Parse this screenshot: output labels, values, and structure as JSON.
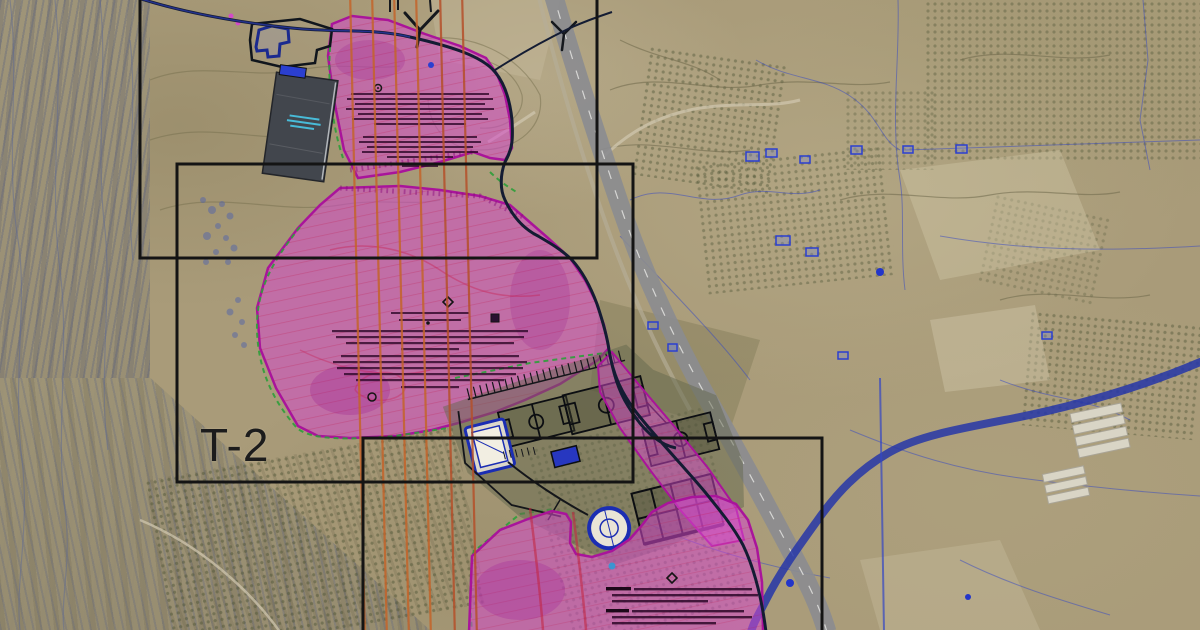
{
  "map": {
    "kind": "aerial-orthophoto-with-cad-plan-overlay",
    "frame_label": "T-2",
    "colors": {
      "terrain_tan": "#a99b79",
      "zone_fill_magenta": "#d648cc",
      "zone_border_magenta": "#a9149b",
      "hatch_crimson": "#be143c",
      "orange_utility_line": "#c4642a",
      "green_dashed_boundary": "#2e9e3a",
      "cad_blue": "#2b3fd0",
      "road_dark": "#141c33",
      "highway_grey": "#8b8c90",
      "river_blue": "#2636a8",
      "frame_black": "#141414"
    },
    "features": {
      "frames": [
        "upper-plan-frame",
        "t2-plan-frame",
        "lower-plan-frame"
      ],
      "zones": [
        "north-zone",
        "central-zone",
        "road-corridor-zone",
        "south-zone"
      ],
      "sports_complex": [
        "field-a",
        "field-b",
        "field-c",
        "court-grid",
        "pool-building",
        "service-building",
        "circular-building"
      ]
    }
  }
}
